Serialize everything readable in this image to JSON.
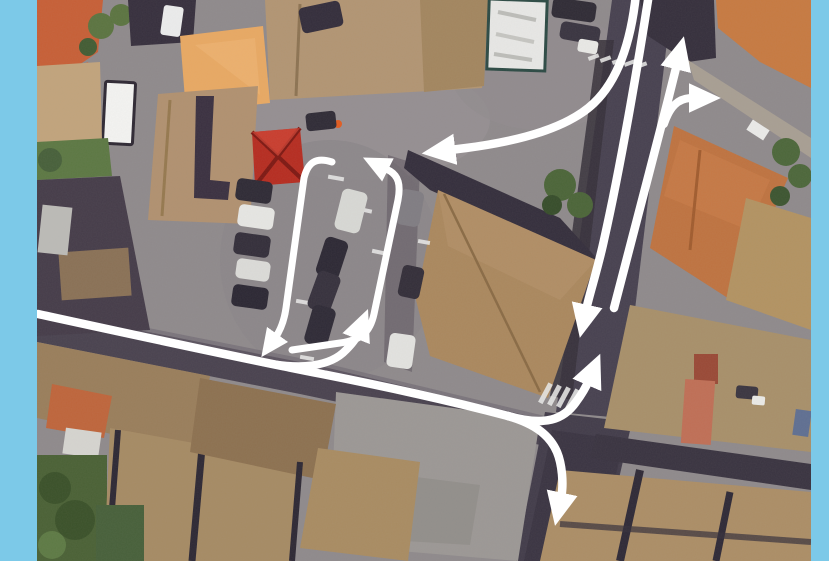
{
  "scene": {
    "type": "aerial-satellite-photo-with-traffic-flow-annotations",
    "frame_color": "#7cc9e8",
    "arrow_color": "#ffffff",
    "photo_frame": {
      "left": 37,
      "top": 0,
      "width": 774,
      "height": 561
    },
    "features": {
      "parking_lot": "central parking area with one-way loop",
      "north_road": "two-way vertical road on the right",
      "west_street": "street entering from the left edge",
      "south_road": "road exiting bottom centre-right",
      "red_tent": "red pavilion at parking north-west corner",
      "crosswalk": "zebra crossing south of the junction"
    }
  },
  "annotations": {
    "arrows": [
      {
        "name": "flow-north-entry-west-turn",
        "d": "M 636 -6 C 631 42 618 80 594 103 C 568 128 520 141 466 148 L 450 150",
        "w": 8.5,
        "head": true
      },
      {
        "name": "flow-southbound-lane",
        "d": "M 649 -6 C 640 52 622 160 604 240 C 598 268 590 292 586 310",
        "w": 8.5,
        "head": true
      },
      {
        "name": "flow-northbound-lane",
        "d": "M 614 308 C 626 262 650 170 668 100 L 677 64",
        "w": 8.5,
        "head": true
      },
      {
        "name": "flow-northbound-right-turn",
        "d": "M 664 124 C 670 106 678 99 690 98 L 694 98",
        "w": 8,
        "head": true
      },
      {
        "name": "flow-west-street",
        "d": "M 38 314 C 130 334 240 358 322 374 C 408 391 470 406 508 416",
        "w": 8.5,
        "head": false
      },
      {
        "name": "flow-turn-north-at-junction",
        "d": "M 508 416 C 546 427 564 419 576 402 C 582 394 586 387 589 380",
        "w": 8.5,
        "head": true
      },
      {
        "name": "flow-continue-south",
        "d": "M 508 416 C 536 424 550 436 557 452 C 562 464 564 484 561 498",
        "w": 8.5,
        "head": true
      },
      {
        "name": "flow-parking-entry",
        "d": "M 262 362 C 300 370 330 367 346 350 C 352 344 356 339 358 334",
        "w": 8,
        "head": true
      },
      {
        "name": "flow-parking-loop-north-side",
        "d": "M 292 350 L 340 343 C 362 340 370 332 374 314 L 398 200 C 401 184 398 176 390 171 L 384 168",
        "w": 7,
        "head": true
      },
      {
        "name": "flow-parking-loop-exit",
        "d": "M 332 162 C 316 157 308 162 304 178 L 286 308 C 284 322 280 331 275 338",
        "w": 7,
        "head": true
      }
    ]
  }
}
